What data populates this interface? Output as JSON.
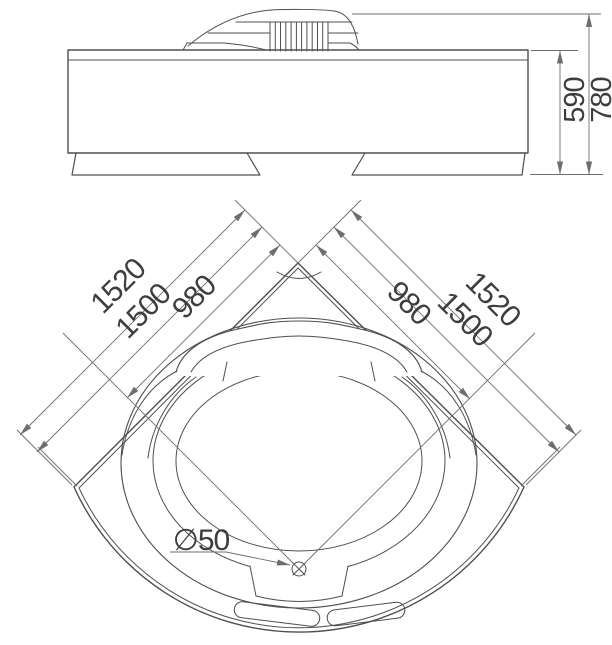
{
  "title": "Corner bathtub technical drawing",
  "front_view": {
    "name": "front elevation view",
    "dim_tub_height": "590",
    "dim_total_height": "780"
  },
  "plan_view": {
    "name": "top plan view",
    "left_dims": [
      "1520",
      "1500",
      "980"
    ],
    "right_dims": [
      "980",
      "1500",
      "1520"
    ],
    "drain_label": "∅50"
  },
  "colors": {
    "line": "#4f4f4f",
    "dim": "#6e6e6e",
    "text": "#3d3d3d",
    "background": "#ffffff"
  }
}
